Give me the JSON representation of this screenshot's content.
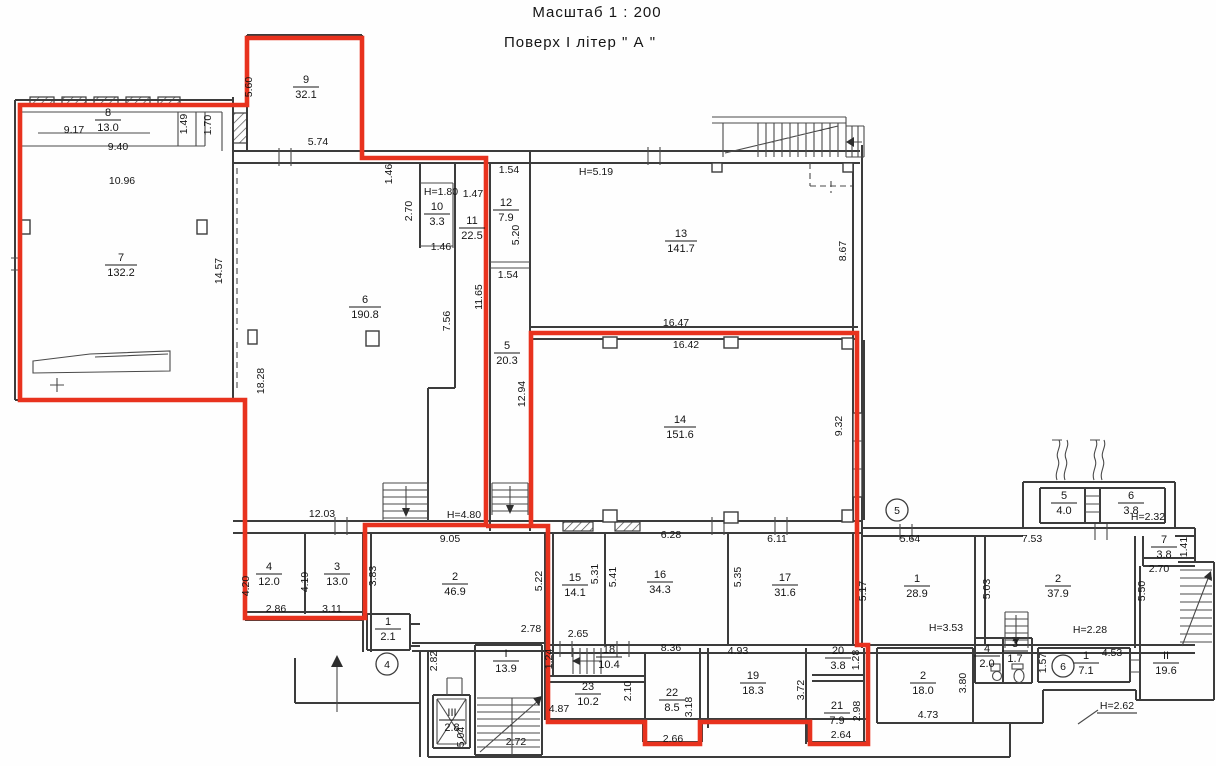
{
  "title": {
    "scale_line": "Масштаб  1 : 200",
    "floor_line": "Поверх   І   літер \" А \""
  },
  "colors": {
    "outline_red": "#e8321e",
    "wall": "#3c3c3c"
  },
  "red_outline": {
    "paths": [
      "M20,105 H247 V38 H362 V158 H486 V525 H365 V618 H245 V400 H20 Z",
      "M486,526 H548 V722 H645 V744 H700 V722 H810 V744 H868 V645 H857 V333 H531 V526"
    ]
  },
  "rooms": [
    {
      "n": "8",
      "a": "13.0",
      "x": 108,
      "y": 119
    },
    {
      "n": "7",
      "a": "132.2",
      "x": 121,
      "y": 264
    },
    {
      "n": "9",
      "a": "32.1",
      "x": 306,
      "y": 86
    },
    {
      "n": "10",
      "a": "3.3",
      "x": 437,
      "y": 213
    },
    {
      "n": "11",
      "a": "22.5",
      "x": 472,
      "y": 227
    },
    {
      "n": "12",
      "a": "7.9",
      "x": 506,
      "y": 209
    },
    {
      "n": "5",
      "a": "20.3",
      "x": 507,
      "y": 352
    },
    {
      "n": "6",
      "a": "190.8",
      "x": 365,
      "y": 306
    },
    {
      "n": "13",
      "a": "141.7",
      "x": 681,
      "y": 240
    },
    {
      "n": "14",
      "a": "151.6",
      "x": 680,
      "y": 426
    },
    {
      "n": "4",
      "a": "12.0",
      "x": 269,
      "y": 573
    },
    {
      "n": "3",
      "a": "13.0",
      "x": 337,
      "y": 573
    },
    {
      "n": "2",
      "a": "46.9",
      "x": 455,
      "y": 583
    },
    {
      "n": "1",
      "a": "2.1",
      "x": 388,
      "y": 628
    },
    {
      "n": "15",
      "a": "14.1",
      "x": 575,
      "y": 584
    },
    {
      "n": "16",
      "a": "34.3",
      "x": 660,
      "y": 581
    },
    {
      "n": "17",
      "a": "31.6",
      "x": 785,
      "y": 584
    },
    {
      "n": "1",
      "a": "28.9",
      "x": 917,
      "y": 585
    },
    {
      "n": "2",
      "a": "37.9",
      "x": 1058,
      "y": 585
    },
    {
      "n": "5",
      "a": "4.0",
      "x": 1064,
      "y": 502
    },
    {
      "n": "6",
      "a": "3.8",
      "x": 1131,
      "y": 502
    },
    {
      "n": "7",
      "a": "3.8",
      "x": 1164,
      "y": 546
    },
    {
      "n": "II",
      "a": "19.6",
      "x": 1166,
      "y": 662
    },
    {
      "n": "I",
      "a": "13.9",
      "x": 506,
      "y": 660
    },
    {
      "n": "III",
      "a": "2.8",
      "x": 452,
      "y": 719
    },
    {
      "n": "18",
      "a": "10.4",
      "x": 609,
      "y": 656
    },
    {
      "n": "23",
      "a": "10.2",
      "x": 588,
      "y": 693
    },
    {
      "n": "22",
      "a": "8.5",
      "x": 672,
      "y": 699
    },
    {
      "n": "19",
      "a": "18.3",
      "x": 753,
      "y": 682
    },
    {
      "n": "20",
      "a": "3.8",
      "x": 838,
      "y": 657
    },
    {
      "n": "21",
      "a": "7.9",
      "x": 837,
      "y": 712
    },
    {
      "n": "2",
      "a": "18.0",
      "x": 923,
      "y": 682
    },
    {
      "n": "4",
      "a": "2.0",
      "x": 987,
      "y": 655
    },
    {
      "n": "3",
      "a": "1.7",
      "x": 1015,
      "y": 650
    },
    {
      "n": "1",
      "a": "7.1",
      "x": 1086,
      "y": 662
    }
  ],
  "dims": [
    {
      "t": "9.17",
      "x": 74,
      "y": 133
    },
    {
      "t": "9.40",
      "x": 118,
      "y": 150
    },
    {
      "t": "10.96",
      "x": 122,
      "y": 184
    },
    {
      "t": "1.49",
      "x": 187,
      "y": 124,
      "v": 1
    },
    {
      "t": "1.70",
      "x": 211,
      "y": 125,
      "v": 1
    },
    {
      "t": "5.60",
      "x": 252,
      "y": 87,
      "v": 1
    },
    {
      "t": "5.74",
      "x": 318,
      "y": 145
    },
    {
      "t": "14.57",
      "x": 222,
      "y": 271,
      "v": 1
    },
    {
      "t": "18.28",
      "x": 264,
      "y": 381,
      "v": 1
    },
    {
      "t": "12.03",
      "x": 322,
      "y": 517
    },
    {
      "t": "1.46",
      "x": 392,
      "y": 174,
      "v": 1
    },
    {
      "t": "2.70",
      "x": 412,
      "y": 211,
      "v": 1
    },
    {
      "t": "1.47",
      "x": 473,
      "y": 197
    },
    {
      "t": "1.46",
      "x": 441,
      "y": 250
    },
    {
      "t": "7.56",
      "x": 450,
      "y": 321,
      "v": 1
    },
    {
      "t": "11.65",
      "x": 482,
      "y": 297,
      "v": 1
    },
    {
      "t": "1.54",
      "x": 509,
      "y": 173
    },
    {
      "t": "5.20",
      "x": 519,
      "y": 235,
      "v": 1
    },
    {
      "t": "1.54",
      "x": 508,
      "y": 278
    },
    {
      "t": "12.94",
      "x": 525,
      "y": 394,
      "v": 1
    },
    {
      "t": "8.67",
      "x": 846,
      "y": 251,
      "v": 1
    },
    {
      "t": "16.47",
      "x": 676,
      "y": 326
    },
    {
      "t": "16.42",
      "x": 686,
      "y": 348
    },
    {
      "t": "9.32",
      "x": 842,
      "y": 426,
      "v": 1
    },
    {
      "t": "9.05",
      "x": 450,
      "y": 542
    },
    {
      "t": "3.83",
      "x": 376,
      "y": 576,
      "v": 1
    },
    {
      "t": "4.20",
      "x": 249,
      "y": 586,
      "v": 1
    },
    {
      "t": "4.19",
      "x": 308,
      "y": 582,
      "v": 1
    },
    {
      "t": "2.86",
      "x": 276,
      "y": 612
    },
    {
      "t": "3.11",
      "x": 332,
      "y": 612
    },
    {
      "t": "5.22",
      "x": 542,
      "y": 581,
      "v": 1
    },
    {
      "t": "2.78",
      "x": 531,
      "y": 632
    },
    {
      "t": "2.65",
      "x": 578,
      "y": 637
    },
    {
      "t": "5.31",
      "x": 598,
      "y": 574,
      "v": 1
    },
    {
      "t": "5.41",
      "x": 616,
      "y": 577,
      "v": 1
    },
    {
      "t": "6.28",
      "x": 671,
      "y": 538
    },
    {
      "t": "6.11",
      "x": 777,
      "y": 542
    },
    {
      "t": "5.35",
      "x": 741,
      "y": 577,
      "v": 1
    },
    {
      "t": "5.17",
      "x": 866,
      "y": 591,
      "v": 1
    },
    {
      "t": "5.64",
      "x": 910,
      "y": 542
    },
    {
      "t": "7.53",
      "x": 1032,
      "y": 542
    },
    {
      "t": "5.03",
      "x": 990,
      "y": 589,
      "v": 1
    },
    {
      "t": "1.41",
      "x": 1187,
      "y": 547,
      "v": 1
    },
    {
      "t": "2.70",
      "x": 1159,
      "y": 572
    },
    {
      "t": "5.50",
      "x": 1145,
      "y": 591,
      "v": 1
    },
    {
      "t": "8.36",
      "x": 671,
      "y": 651
    },
    {
      "t": "4.93",
      "x": 738,
      "y": 654
    },
    {
      "t": "1.24",
      "x": 552,
      "y": 659,
      "v": 1
    },
    {
      "t": "2.10",
      "x": 631,
      "y": 691,
      "v": 1
    },
    {
      "t": "4.87",
      "x": 559,
      "y": 712
    },
    {
      "t": "3.18",
      "x": 692,
      "y": 707,
      "v": 1
    },
    {
      "t": "2.66",
      "x": 673,
      "y": 742
    },
    {
      "t": "3.72",
      "x": 804,
      "y": 690,
      "v": 1
    },
    {
      "t": "1.28",
      "x": 859,
      "y": 660,
      "v": 1
    },
    {
      "t": "2.98",
      "x": 860,
      "y": 711,
      "v": 1
    },
    {
      "t": "2.64",
      "x": 841,
      "y": 738
    },
    {
      "t": "2.82",
      "x": 437,
      "y": 661,
      "v": 1
    },
    {
      "t": "5.04",
      "x": 464,
      "y": 737,
      "v": 1
    },
    {
      "t": "2.72",
      "x": 516,
      "y": 745
    },
    {
      "t": "3.80",
      "x": 966,
      "y": 683,
      "v": 1
    },
    {
      "t": "4.73",
      "x": 928,
      "y": 718
    },
    {
      "t": "1.57",
      "x": 1046,
      "y": 663,
      "v": 1
    },
    {
      "t": "4.53",
      "x": 1112,
      "y": 656
    }
  ],
  "heights": [
    {
      "t": "H=1.80",
      "x": 441,
      "y": 195
    },
    {
      "t": "H=5.19",
      "x": 596,
      "y": 175
    },
    {
      "t": "H=4.80",
      "x": 464,
      "y": 518
    },
    {
      "t": "H=2.32",
      "x": 1148,
      "y": 520
    },
    {
      "t": "H=3.53",
      "x": 946,
      "y": 631
    },
    {
      "t": "H=2.28",
      "x": 1090,
      "y": 633
    },
    {
      "t": "H=2.62",
      "x": 1117,
      "y": 709,
      "u": 1
    }
  ],
  "circled_refs": [
    {
      "t": "4",
      "x": 387,
      "y": 664
    },
    {
      "t": "5",
      "x": 897,
      "y": 510
    },
    {
      "t": "6",
      "x": 1063,
      "y": 666
    }
  ]
}
